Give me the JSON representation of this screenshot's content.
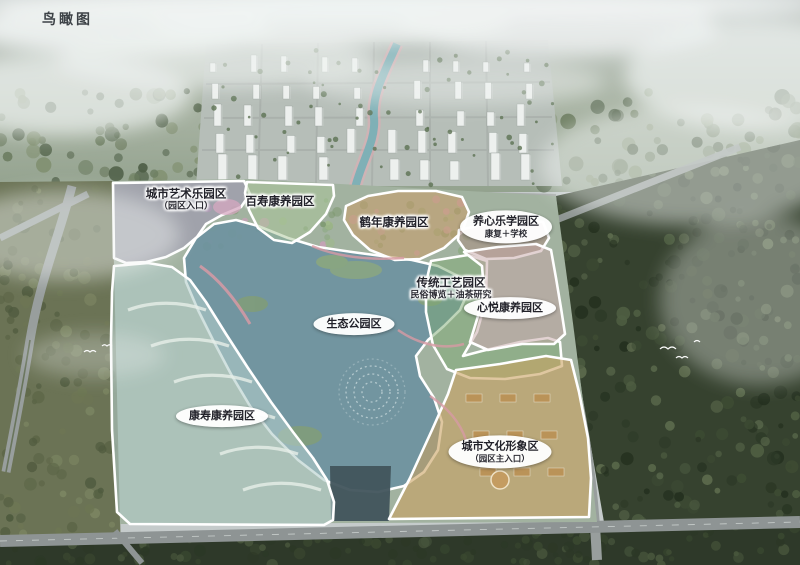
{
  "title": "鸟瞰图",
  "zones": [
    {
      "id": "city-art-park",
      "label": "城市艺术乐园区",
      "sublabel": "（园区入口）",
      "color": "#9e92b6",
      "label_style": "halo"
    },
    {
      "id": "baishou-wellness",
      "label": "百寿康养园区",
      "sublabel": "",
      "color": "#a9c698",
      "label_style": "halo"
    },
    {
      "id": "henian-wellness",
      "label": "鹤年康养园区",
      "sublabel": "",
      "color": "#c79e6d",
      "label_style": "halo"
    },
    {
      "id": "yangxin-learning",
      "label": "养心乐学园区",
      "sublabel": "康复＋学校",
      "color": "#aa897d",
      "label_style": "bubble"
    },
    {
      "id": "traditional-crafts",
      "label": "传统工艺园区",
      "sublabel": "民俗博览＋油茶研究",
      "color": "#7da973",
      "label_style": "halo"
    },
    {
      "id": "xinyue-wellness",
      "label": "心悦康养园区",
      "sublabel": "",
      "color": "#c6a6a6",
      "label_style": "bubble"
    },
    {
      "id": "eco-park",
      "label": "生态公园区",
      "sublabel": "",
      "color": "#6e93a0",
      "label_style": "bubble"
    },
    {
      "id": "kangshou-wellness",
      "label": "康寿康养园区",
      "sublabel": "",
      "color": "#b2cdca",
      "label_style": "bubble"
    },
    {
      "id": "city-culture-image",
      "label": "城市文化形象区",
      "sublabel": "（园区主入口）",
      "color": "#caa261",
      "label_style": "bubble"
    }
  ],
  "scene": {
    "water_color": "#6e93a0",
    "zone_border_color": "#ffffff",
    "road_color": "#989e9d",
    "forest_dark_color": "#36422f",
    "forest_olive_color": "#6b7355",
    "mist_color": "#f0f3f2"
  }
}
